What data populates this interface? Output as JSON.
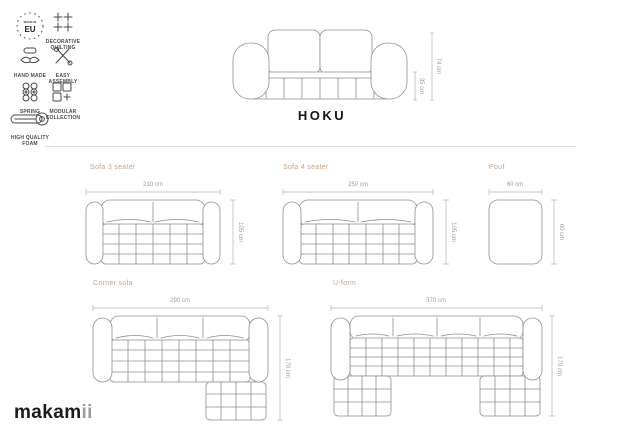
{
  "title": "HOKU",
  "brand": {
    "main": "makam",
    "suffix": "ii"
  },
  "badges": {
    "eu_top": "MADE IN",
    "eu_main": "EU",
    "quilting": "DECORATIVE QUILTING",
    "hand_made": "HAND MADE",
    "easy_assembly": "EASY ASSEMBLY",
    "spring": "SPRING",
    "modular": "MODULAR COLLECTION",
    "foam": "HIGH QUALITY FOAM"
  },
  "front_view": {
    "total_height": "74 cm",
    "seat_height": "35 cm"
  },
  "diagrams": [
    {
      "name": "Sofa 3 seater",
      "width": "210 cm",
      "depth": "105 cm"
    },
    {
      "name": "Sofa 4 seater",
      "width": "250 cm",
      "depth": "105 cm"
    },
    {
      "name": "Pouf",
      "width": "60 cm",
      "depth": "60 cm"
    },
    {
      "name": "Corner sofa",
      "width": "290 cm",
      "depth": "170 cm"
    },
    {
      "name": "U-form",
      "width": "370 cm",
      "depth": "170 cm"
    }
  ],
  "colors": {
    "accent_tan": "#c2a488",
    "dim_text": "#9a9a9a",
    "line_gray": "#8f8f8f",
    "divider": "#dcdcdc",
    "ink": "#141414"
  }
}
